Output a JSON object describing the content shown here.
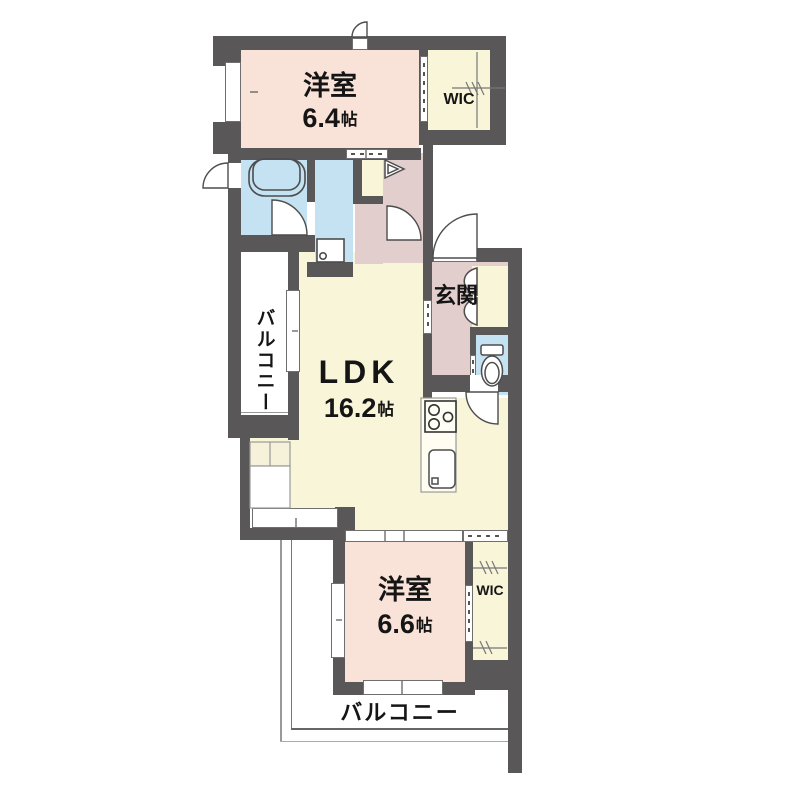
{
  "floorplan": {
    "rooms": {
      "bedroom_top": {
        "name": "洋室",
        "size_value": "6.4",
        "size_unit": "帖"
      },
      "wic_top": {
        "label": "WIC"
      },
      "balcony_left": {
        "label": "バルコニー"
      },
      "entrance": {
        "label": "玄関"
      },
      "ldk": {
        "name": "LDK",
        "size_value": "16.2",
        "size_unit": "帖"
      },
      "bedroom_bottom": {
        "name": "洋室",
        "size_value": "6.6",
        "size_unit": "帖"
      },
      "wic_bottom": {
        "label": "WIC"
      },
      "balcony_bottom": {
        "label": "バルコニー"
      }
    },
    "colors": {
      "wall": "#595757",
      "bedroom": "#f9e2d8",
      "ldk_wic": "#f8f5d8",
      "wet_area": "#c4e2f1",
      "entry_hall": "#e2cecd",
      "balcony": "#ffffff"
    },
    "fixtures": [
      "bathtub",
      "washer-pan",
      "closet-folding-door",
      "shoe-cabinet",
      "toilet",
      "stove",
      "kitchen-sink",
      "counter"
    ]
  }
}
